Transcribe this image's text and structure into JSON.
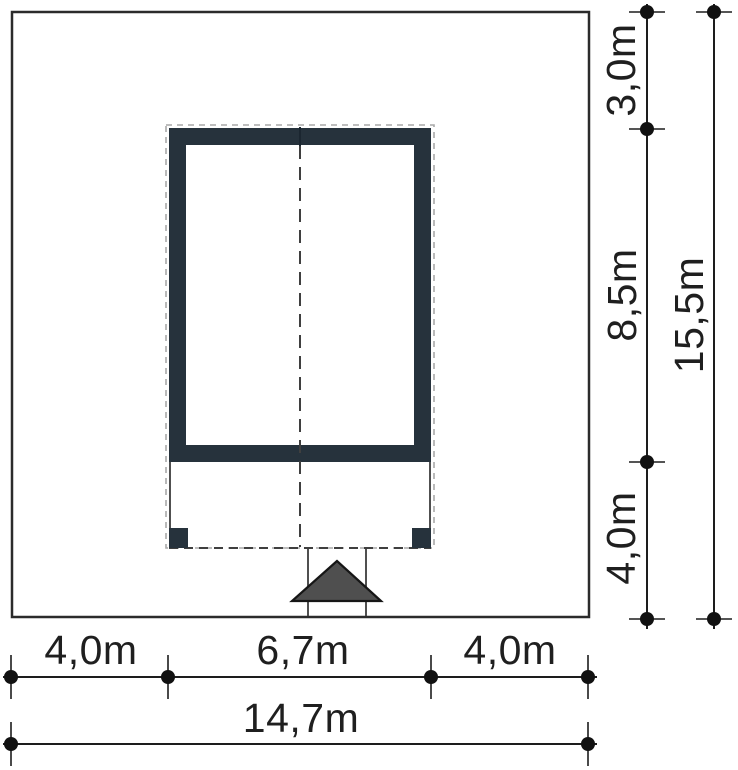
{
  "figure": {
    "type": "architectural-site-plan",
    "unit": "m"
  },
  "colors": {
    "plot_outline": "#2b2b2b",
    "wall": "#26323c",
    "pillar": "#26323c",
    "arrow_fill": "#4f4f4f",
    "arrow_stroke": "#161616",
    "dash": "#3f3f3f",
    "roof_halo": "#a9a9a9",
    "dim": "#1d1d1d"
  },
  "dims": {
    "right_top": "3,0m",
    "right_middle": "8,5m",
    "right_bottom": "4,0m",
    "right_total": "15,5m",
    "bottom_left": "4,0m",
    "bottom_center": "6,7m",
    "bottom_right": "4,0m",
    "bottom_total": "14,7m"
  }
}
